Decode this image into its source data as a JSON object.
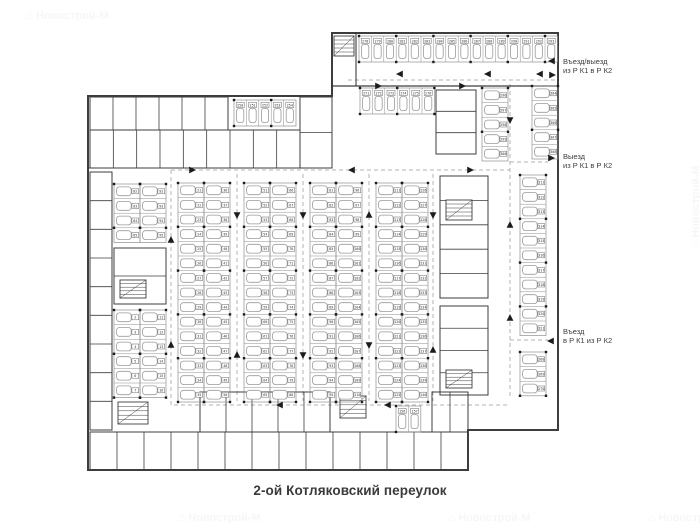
{
  "title": {
    "street": "2-ой Котляковский переулок"
  },
  "annotations": [
    {
      "line1": "Въезд/выезд",
      "line2": "из Р К1 в Р К2"
    },
    {
      "line1": "Выезд",
      "line2": "из Р К1 в Р К2"
    },
    {
      "line1": "Въезд",
      "line2": "в Р К1 из Р К2"
    }
  ],
  "watermark": {
    "icon": "⌂",
    "text": "Новострой-М"
  },
  "colors": {
    "wall": "#3d3d3d",
    "stall": "#8f8f8f",
    "car": "#9a9a9a",
    "chip": "#666666",
    "lane": "#b3b3b3",
    "arrow": "#1c1c1c",
    "annotation_text": "#3b3b3b",
    "title_text": "#3a3a3a",
    "watermark": "#9a9a9a"
  },
  "plan": {
    "walls": [
      {
        "d": "M88,96 H332 V33 H558 V430 H468 V470 H88 Z",
        "w": 2
      },
      {
        "d": "M88,168 H332",
        "w": 1.1
      },
      {
        "d": "M356,33 V86",
        "w": 1.1
      },
      {
        "d": "M332,86 H558",
        "w": 1.3
      }
    ],
    "room_blocks": [
      {
        "x": 90,
        "y": 97,
        "w": 138,
        "h": 33,
        "n": 6
      },
      {
        "x": 90,
        "y": 130,
        "w": 210,
        "h": 38,
        "n": 9
      },
      {
        "x": 300,
        "y": 97,
        "w": 32,
        "h": 71,
        "n": 2,
        "dir": "v"
      },
      {
        "x": 436,
        "y": 90,
        "w": 40,
        "h": 64,
        "n": 3,
        "dir": "v"
      },
      {
        "x": 90,
        "y": 172,
        "w": 22,
        "h": 258,
        "n": 9,
        "dir": "v"
      },
      {
        "x": 114,
        "y": 248,
        "w": 52,
        "h": 56,
        "n": 2,
        "dir": "v"
      },
      {
        "x": 440,
        "y": 176,
        "w": 48,
        "h": 122,
        "n": 5,
        "dir": "v"
      },
      {
        "x": 440,
        "y": 306,
        "w": 48,
        "h": 89,
        "n": 4,
        "dir": "v"
      },
      {
        "x": 200,
        "y": 392,
        "w": 130,
        "h": 40,
        "n": 5
      },
      {
        "x": 432,
        "y": 392,
        "w": 36,
        "h": 40,
        "n": 2
      },
      {
        "x": 90,
        "y": 432,
        "w": 378,
        "h": 38,
        "n": 14
      }
    ],
    "stairs": [
      {
        "x": 334,
        "y": 36,
        "w": 20,
        "h": 20
      },
      {
        "x": 120,
        "y": 280,
        "w": 26,
        "h": 18
      },
      {
        "x": 446,
        "y": 200,
        "w": 26,
        "h": 20
      },
      {
        "x": 446,
        "y": 370,
        "w": 26,
        "h": 18
      },
      {
        "x": 340,
        "y": 396,
        "w": 26,
        "h": 22
      },
      {
        "x": 118,
        "y": 402,
        "w": 30,
        "h": 22
      }
    ],
    "stall_rows": [
      {
        "x": 359,
        "y": 36,
        "n": 16,
        "dir": "v",
        "start": 278
      },
      {
        "x": 360,
        "y": 88,
        "n": 6,
        "dir": "v",
        "start": 271
      },
      {
        "x": 234,
        "y": 100,
        "n": 5,
        "dir": "v",
        "start": 250
      },
      {
        "x": 178,
        "y": 183,
        "n": 15,
        "dir": "h",
        "start": 21
      },
      {
        "x": 204,
        "y": 183,
        "n": 15,
        "dir": "h",
        "start": 36
      },
      {
        "x": 244,
        "y": 183,
        "n": 15,
        "dir": "h",
        "start": 51
      },
      {
        "x": 270,
        "y": 183,
        "n": 15,
        "dir": "h",
        "start": 66
      },
      {
        "x": 310,
        "y": 183,
        "n": 15,
        "dir": "h",
        "start": 81
      },
      {
        "x": 336,
        "y": 183,
        "n": 15,
        "dir": "h",
        "start": 96
      },
      {
        "x": 376,
        "y": 183,
        "n": 15,
        "dir": "h",
        "start": 111
      },
      {
        "x": 402,
        "y": 183,
        "n": 15,
        "dir": "h",
        "start": 126
      },
      {
        "x": 114,
        "y": 184,
        "n": 4,
        "dir": "h",
        "start": 82
      },
      {
        "x": 140,
        "y": 184,
        "n": 4,
        "dir": "h",
        "start": 92
      },
      {
        "x": 114,
        "y": 310,
        "n": 6,
        "dir": "h",
        "start": 2
      },
      {
        "x": 140,
        "y": 310,
        "n": 6,
        "dir": "h",
        "start": 11
      },
      {
        "x": 482,
        "y": 88,
        "n": 5,
        "dir": "h",
        "start": 296
      },
      {
        "x": 532,
        "y": 86,
        "n": 5,
        "dir": "h",
        "start": 304
      },
      {
        "x": 520,
        "y": 175,
        "n": 11,
        "dir": "h",
        "start": 311
      },
      {
        "x": 520,
        "y": 352,
        "n": 3,
        "dir": "h",
        "start": 268
      },
      {
        "x": 396,
        "y": 406,
        "n": 2,
        "dir": "v",
        "start": 156
      }
    ],
    "lanes": [
      "M348,80 H556",
      "M171,170 H510",
      "M171,170 V405 H510",
      "M237,174 V401",
      "M303,174 V401",
      "M369,174 V401",
      "M433,174 V401",
      "M510,84 V398",
      "M510,162 H548",
      "M510,340 H548"
    ],
    "arrows": [
      [
        400,
        74,
        "left"
      ],
      [
        488,
        74,
        "left"
      ],
      [
        540,
        74,
        "left"
      ],
      [
        378,
        86,
        "right"
      ],
      [
        462,
        86,
        "right"
      ],
      [
        192,
        170,
        "right"
      ],
      [
        352,
        170,
        "left"
      ],
      [
        470,
        170,
        "right"
      ],
      [
        171,
        240,
        "up"
      ],
      [
        171,
        345,
        "up"
      ],
      [
        237,
        215,
        "down"
      ],
      [
        237,
        355,
        "up"
      ],
      [
        303,
        215,
        "down"
      ],
      [
        303,
        355,
        "down"
      ],
      [
        369,
        215,
        "up"
      ],
      [
        369,
        345,
        "down"
      ],
      [
        433,
        215,
        "down"
      ],
      [
        433,
        350,
        "up"
      ],
      [
        510,
        120,
        "down"
      ],
      [
        510,
        225,
        "up"
      ],
      [
        510,
        318,
        "up"
      ],
      [
        280,
        405,
        "left"
      ],
      [
        388,
        405,
        "left"
      ],
      [
        552,
        61,
        "left"
      ],
      [
        552,
        75,
        "right"
      ],
      [
        551,
        158,
        "right"
      ],
      [
        551,
        341,
        "left"
      ]
    ]
  }
}
